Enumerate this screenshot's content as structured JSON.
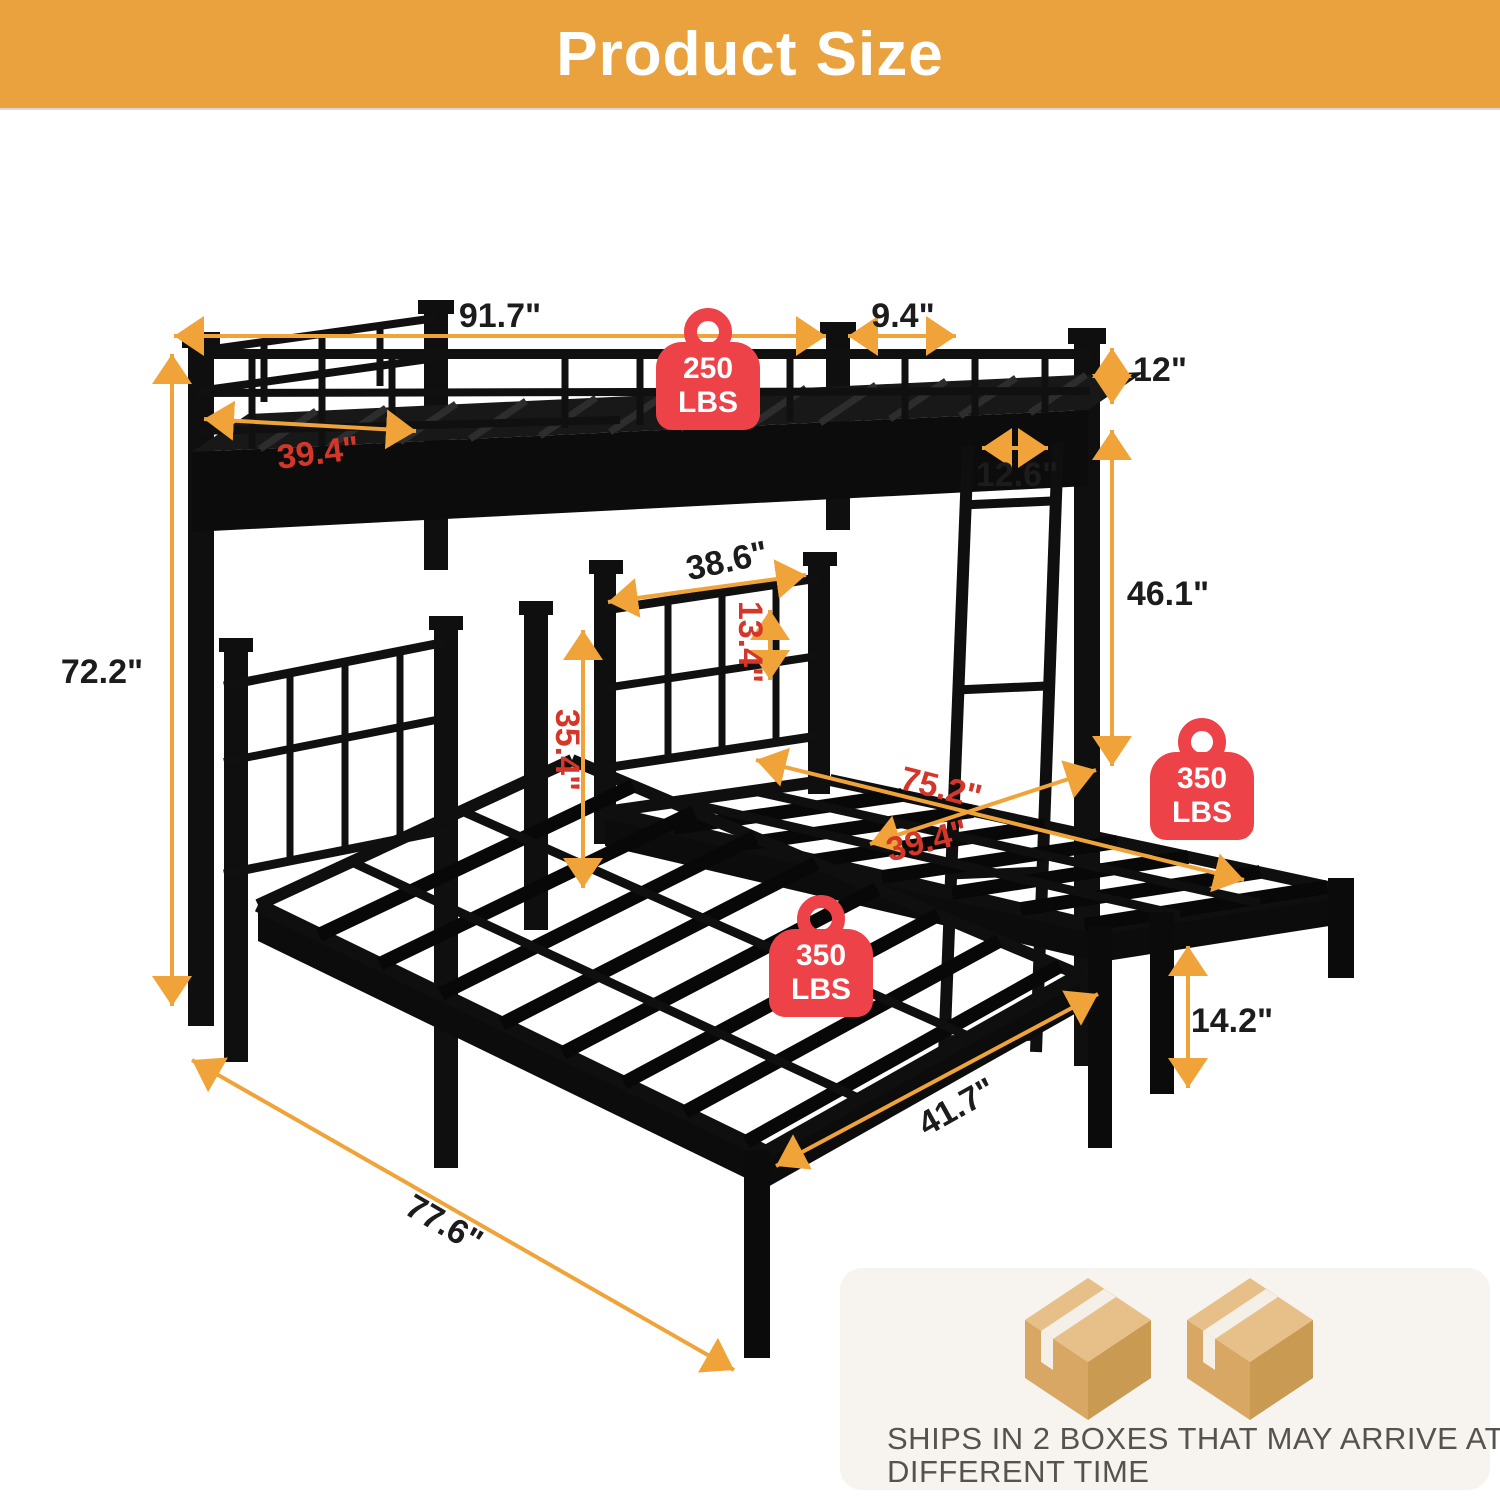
{
  "header": {
    "title": "Product Size"
  },
  "colors": {
    "header_bg": "#E9A23D",
    "arrow_orange": "#F0A339",
    "badge_red": "#EE4249",
    "dim_red": "#D4372A",
    "dim_black": "#1C1C1C",
    "frame_black": "#0F0F0F",
    "panel_bg": "#F7F3EE",
    "panel_text": "#56524D",
    "box_tan": "#D7A763"
  },
  "dimensions": {
    "overall_length": {
      "label": "91.7\""
    },
    "end_overhang": {
      "label": "9.4\""
    },
    "guardrail_height": {
      "label": "12\""
    },
    "top_bunk_width": {
      "label": "39.4\""
    },
    "ladder_width": {
      "label": "12.6\""
    },
    "under_clearance": {
      "label": "46.1\""
    },
    "middle_headboard_width": {
      "label": "38.6\""
    },
    "headboard_rail_gap": {
      "label": "13.4\""
    },
    "lower_headboard_height": {
      "label": "35.4\""
    },
    "right_bed_length": {
      "label": "75.2\""
    },
    "right_bed_width": {
      "label": "39.4\""
    },
    "leg_height": {
      "label": "14.2\""
    },
    "overall_height": {
      "label": "72.2\""
    },
    "left_bed_length": {
      "label": "77.6\""
    },
    "left_bed_width": {
      "label": "41.7\""
    }
  },
  "badges": {
    "top_bunk": {
      "value": "250",
      "unit": "LBS"
    },
    "right_bed": {
      "value": "350",
      "unit": "LBS"
    },
    "left_bed": {
      "value": "350",
      "unit": "LBS"
    }
  },
  "shipping_note": {
    "line1": "SHIPS IN 2 BOXES THAT MAY ARRIVE AT",
    "line2": "DIFFERENT TIME"
  }
}
